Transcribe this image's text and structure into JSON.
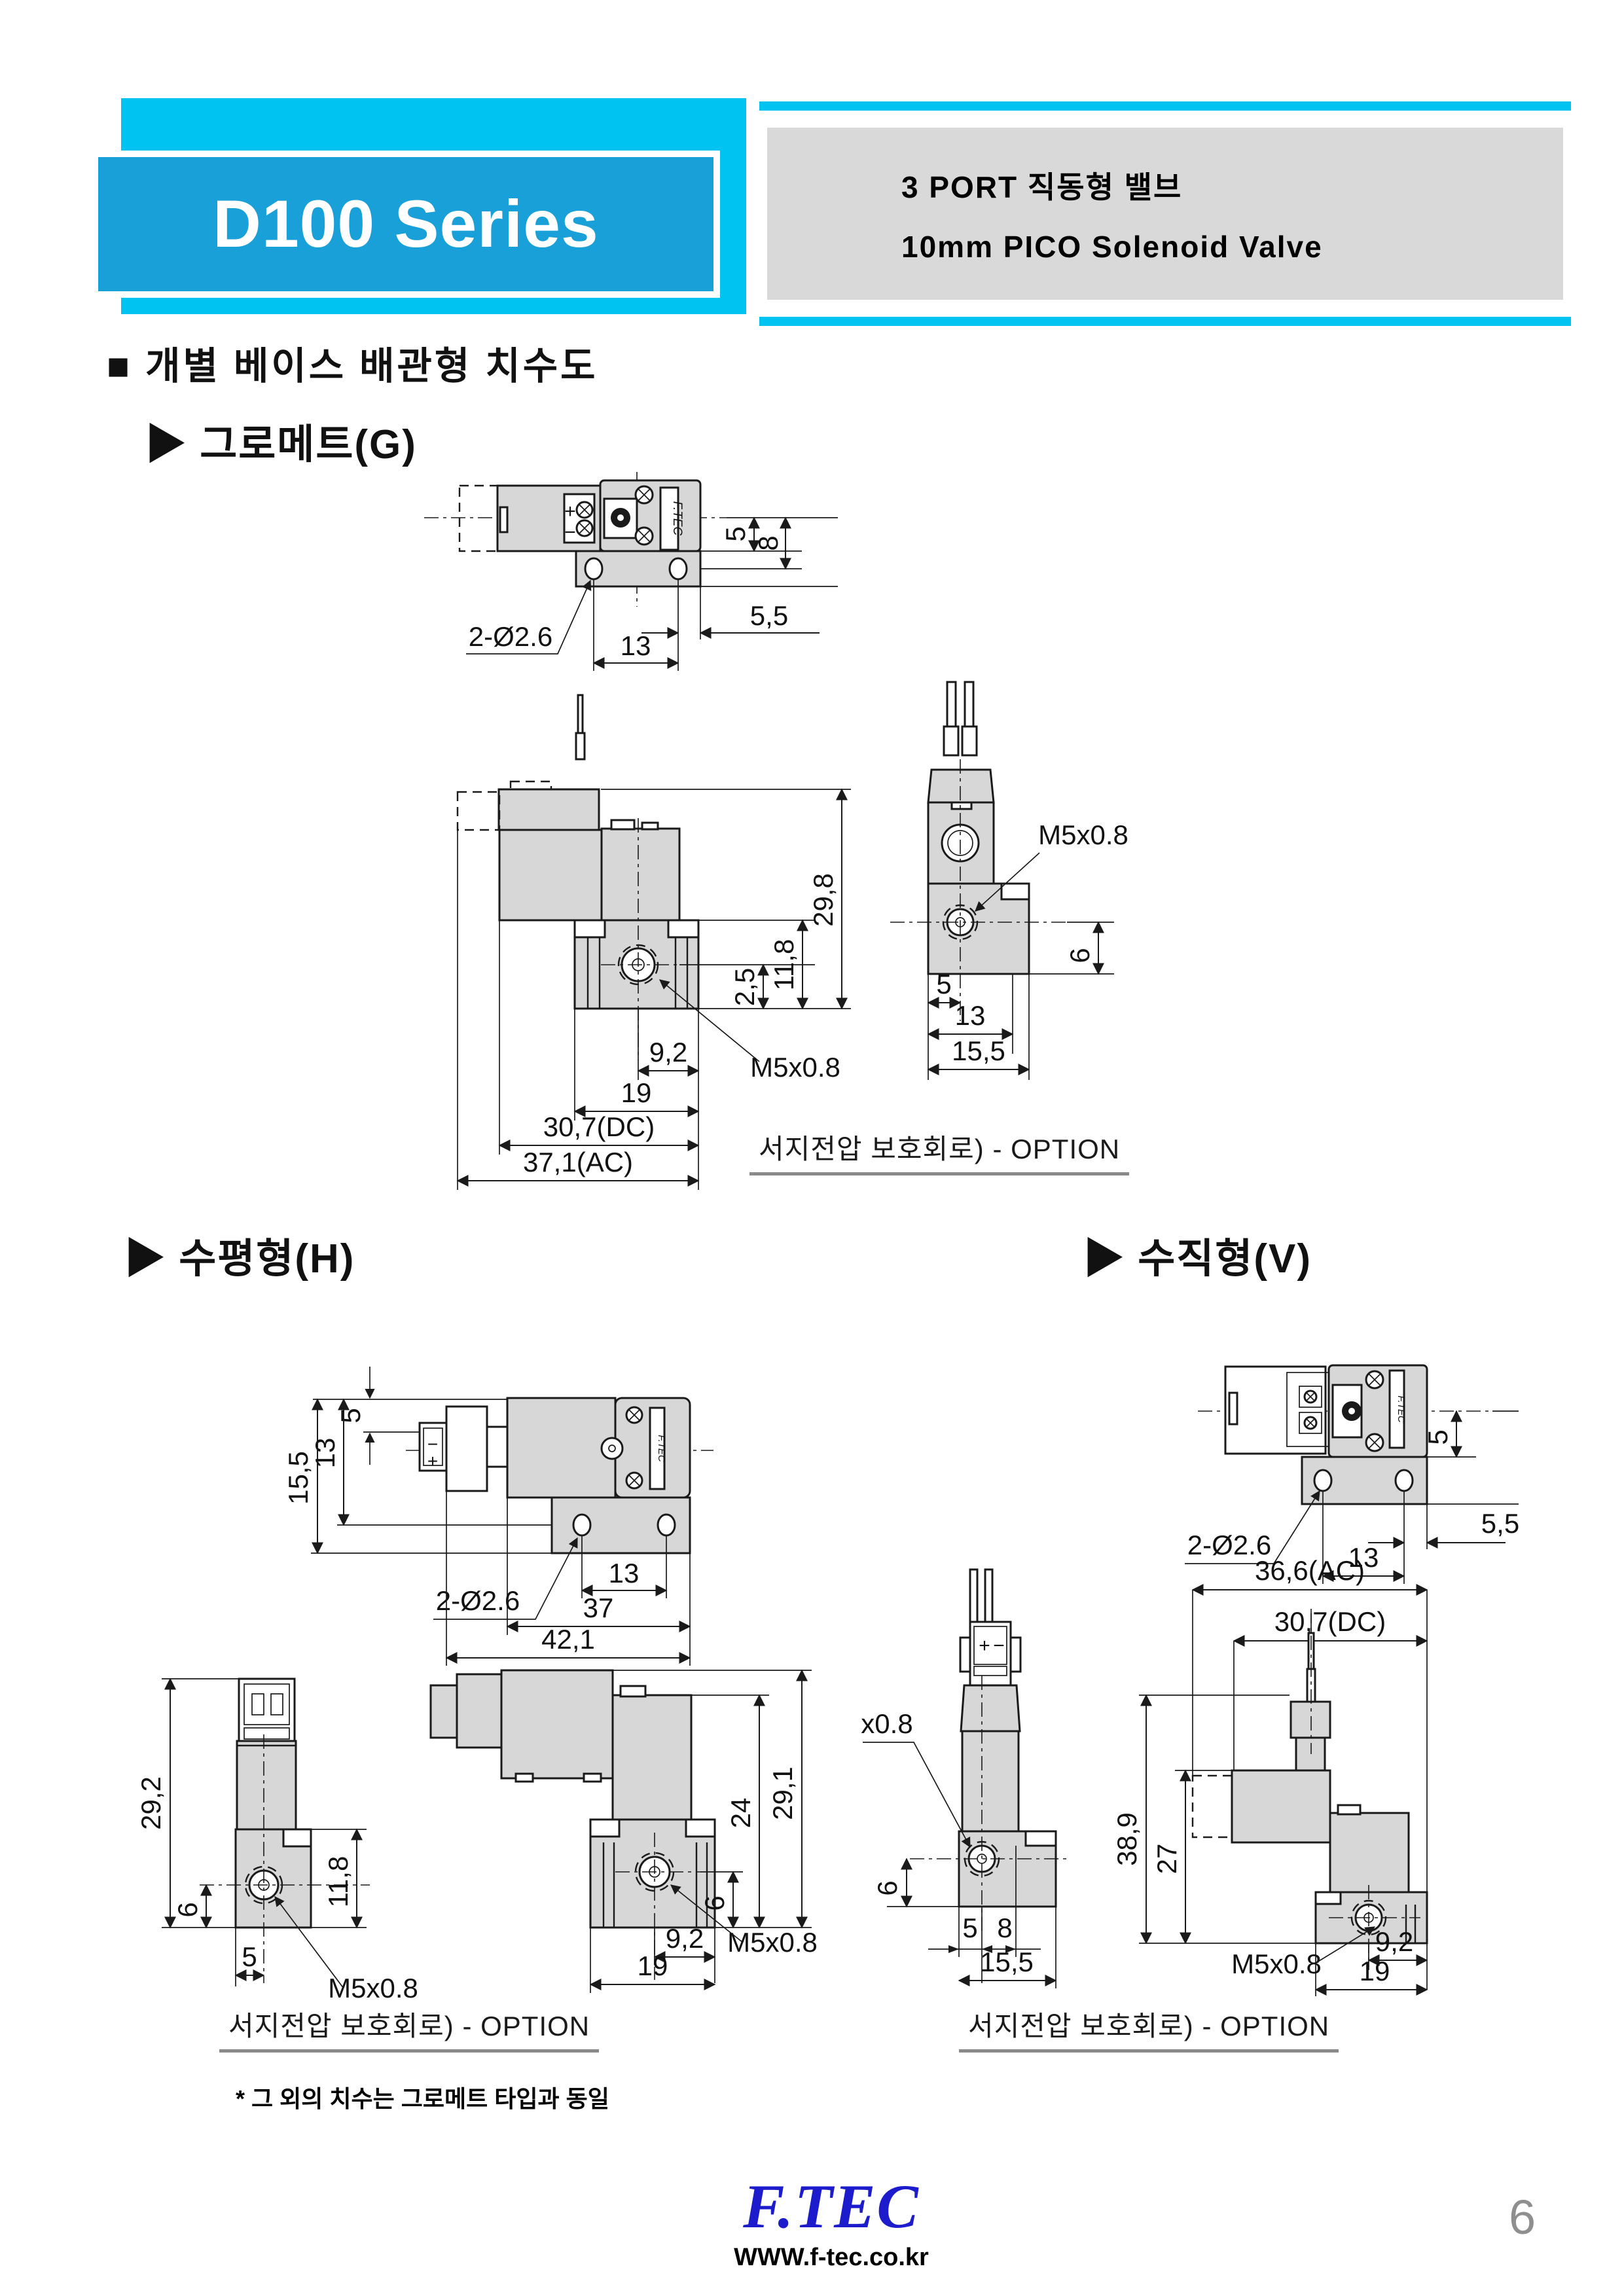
{
  "header": {
    "series": "D100 Series",
    "subtitle_line1": "3 PORT 직동형 밸브",
    "subtitle_line2": "10mm PICO Solenoid Valve"
  },
  "section_title": "■  개별 베이스 배관형 치수도",
  "subsections": {
    "grommet": "▶ 그로메트(G)",
    "horizontal": "▶ 수평형(H)",
    "vertical": "▶ 수직형(V)"
  },
  "captions": {
    "option_g": "서지전압 보호회로) - OPTION",
    "option_h": "서지전압 보호회로) - OPTION",
    "option_v": "서지전압 보호회로) - OPTION",
    "note": "* 그 외의 치수는 그로메트 타입과 동일"
  },
  "footer": {
    "logo": "F.TEC",
    "url": "WWW.f-tec.co.kr",
    "page_number": "6"
  },
  "figures": {
    "g_top": {
      "brand": "F.TEC",
      "terminal_plus": "+",
      "terminal_minus": "−",
      "dims": {
        "holes": "2-Ø2.6",
        "hole_pitch": "13",
        "edge_offset": "5,5",
        "center_to_plate": "5",
        "center_to_hole": "8"
      }
    },
    "g_front": {
      "dims": {
        "total_height": "29,8",
        "base_height": "11,8",
        "port_to_bottom": "2,5",
        "port_offset": "9,2",
        "base_width": "19",
        "dc_width": "30,7(DC)",
        "ac_width": "37,1(AC)",
        "port_thread": "M5x0.8"
      }
    },
    "g_side": {
      "dims": {
        "port_thread": "M5x0.8",
        "port_height": "6",
        "center_offset": "5",
        "width_13": "13",
        "total_width": "15,5"
      }
    },
    "h_top": {
      "brand": "F.TEC",
      "terminal_plus": "+",
      "terminal_minus": "−",
      "dims": {
        "width_155": "15,5",
        "width_13": "13",
        "width_5": "5",
        "holes": "2-Ø2.6",
        "hole_pitch": "13",
        "body_length": "37",
        "total_length": "42,1"
      }
    },
    "h_vert": {
      "dims": {
        "total_height": "29,2",
        "port_height": "6",
        "center_offset": "5",
        "port_thread": "M5x0.8",
        "base_height": "11,8"
      }
    },
    "h_horiz": {
      "dims": {
        "height_24": "24",
        "total_height": "29,1",
        "port_height": "6",
        "port_thread": "M5x0.8",
        "port_offset": "9,2",
        "base_width": "19"
      }
    },
    "v_top": {
      "brand": "F.TEC",
      "dims": {
        "holes": "2-Ø2.6",
        "hole_pitch": "13",
        "center_to_plate": "5",
        "edge_offset": "5,5"
      }
    },
    "v_vert": {
      "terminal_plus": "+",
      "terminal_minus": "−",
      "dims": {
        "port_thread": "x0.8",
        "port_height": "6",
        "width_5": "5",
        "width_8": "8",
        "total_width": "15,5"
      }
    },
    "v_horiz": {
      "dims": {
        "ac_width": "36,6(AC)",
        "dc_width": "30,7(DC)",
        "height_27": "27",
        "total_height": "38,9",
        "port_thread": "M5x0.8",
        "port_offset": "9,2",
        "base_width": "19"
      }
    }
  }
}
